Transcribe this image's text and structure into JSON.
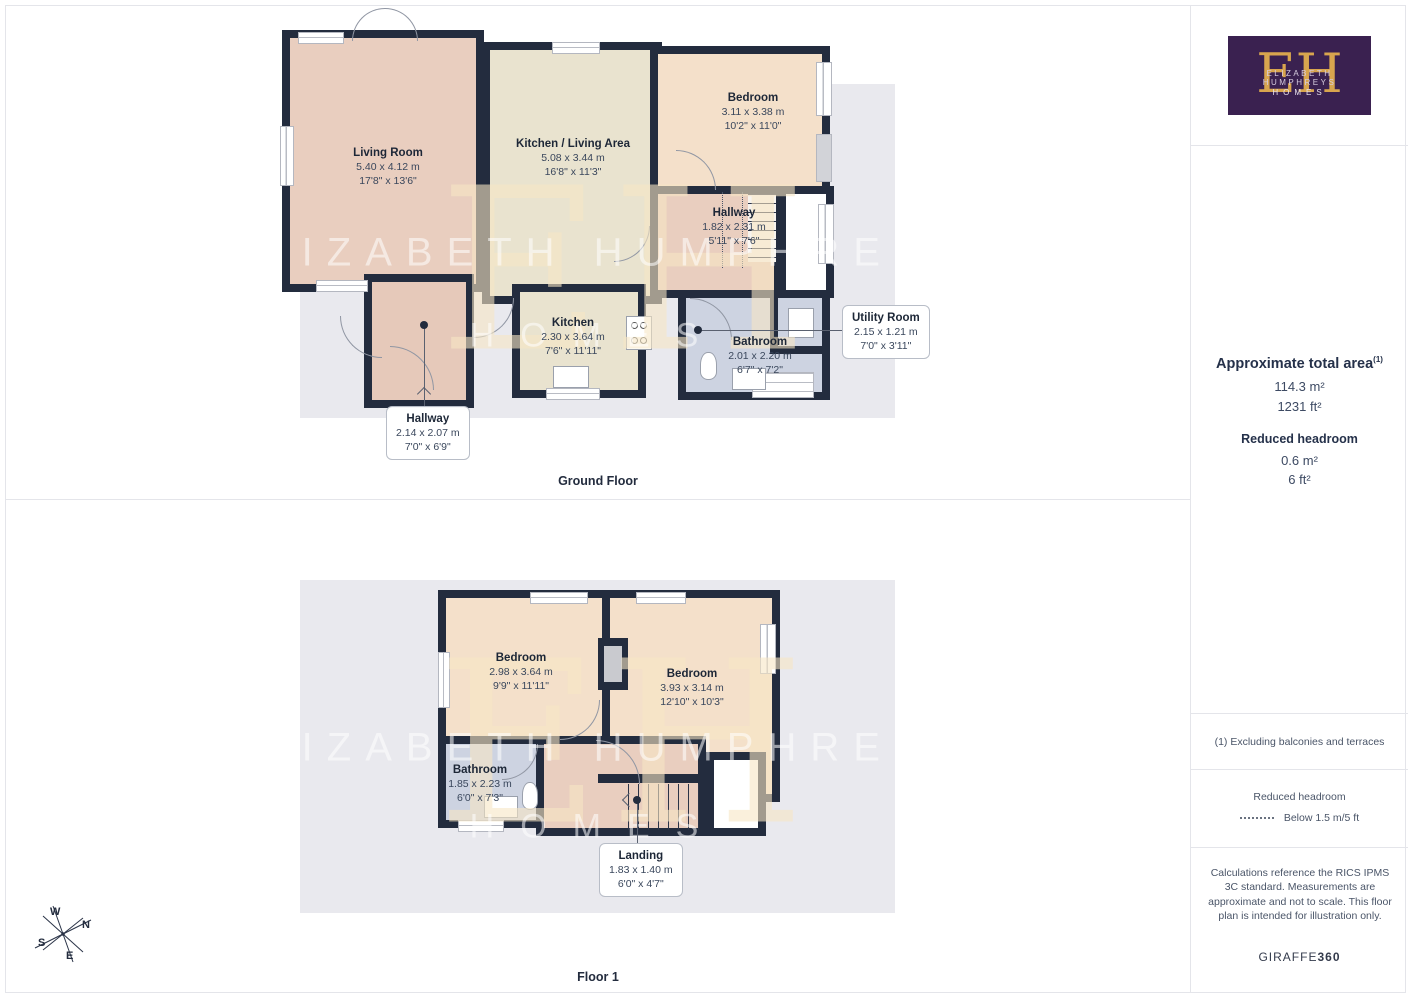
{
  "brand": {
    "monogram": "EH",
    "name_line": "ELIZABETH HUMPHREYS",
    "homes_line": "HOMES"
  },
  "watermark": {
    "monogram": "EH",
    "line1": "ELIZABETH HUMPHREYS",
    "line2": "HOMES"
  },
  "floors": [
    {
      "title": "Ground Floor",
      "rooms": [
        {
          "name": "Living Room",
          "metric": "5.40 x 4.12 m",
          "imperial": "17'8\" x 13'6\""
        },
        {
          "name": "Kitchen / Living Area",
          "metric": "5.08 x 3.44 m",
          "imperial": "16'8\" x 11'3\""
        },
        {
          "name": "Bedroom",
          "metric": "3.11 x 3.38 m",
          "imperial": "10'2\" x 11'0\""
        },
        {
          "name": "Hallway",
          "metric": "1.82 x 2.31 m",
          "imperial": "5'11\" x 7'6\""
        },
        {
          "name": "Kitchen",
          "metric": "2.30 x 3.64 m",
          "imperial": "7'6\" x 11'11\""
        },
        {
          "name": "Bathroom",
          "metric": "2.01 x 2.20 m",
          "imperial": "6'7\" x 7'2\""
        },
        {
          "name": "Utility Room",
          "metric": "2.15 x 1.21 m",
          "imperial": "7'0\" x 3'11\""
        },
        {
          "name": "Hallway",
          "metric": "2.14 x 2.07 m",
          "imperial": "7'0\" x 6'9\""
        }
      ]
    },
    {
      "title": "Floor 1",
      "rooms": [
        {
          "name": "Bedroom",
          "metric": "2.98 x 3.64 m",
          "imperial": "9'9\" x 11'11\""
        },
        {
          "name": "Bedroom",
          "metric": "3.93 x 3.14 m",
          "imperial": "12'10\" x 10'3\""
        },
        {
          "name": "Bathroom",
          "metric": "1.85 x 2.23 m",
          "imperial": "6'0\" x 7'3\""
        },
        {
          "name": "Landing",
          "metric": "1.83 x 1.40 m",
          "imperial": "6'0\" x 4'7\""
        }
      ]
    }
  ],
  "sidebar": {
    "total_area_title": "Approximate total area",
    "total_area_sup": "(1)",
    "total_area_metric": "114.3 m²",
    "total_area_imperial": "1231 ft²",
    "reduced_title": "Reduced headroom",
    "reduced_metric": "0.6 m²",
    "reduced_imperial": "6 ft²",
    "note": "(1) Excluding balconies and terraces",
    "legend_title": "Reduced headroom",
    "legend_label": "Below 1.5 m/5 ft",
    "disclaimer": "Calculations reference the RICS IPMS 3C standard. Measurements are approximate and not to scale. This floor plan is intended for illustration only.",
    "provider_name": "GIRAFFE",
    "provider_number": "360"
  },
  "compass": {
    "n": "N",
    "e": "E",
    "s": "S",
    "w": "W"
  },
  "colors": {
    "wall": "#232c3e",
    "living_pink": "#e9cebf",
    "kitchen_beige": "#e9e3cf",
    "bedroom_peach": "#f4e0ca",
    "bathroom_blue": "#cdd3e1",
    "backdrop_gray": "#e9e9ee",
    "logo_purple": "#3a2150",
    "logo_gold": "#d8a54e"
  }
}
